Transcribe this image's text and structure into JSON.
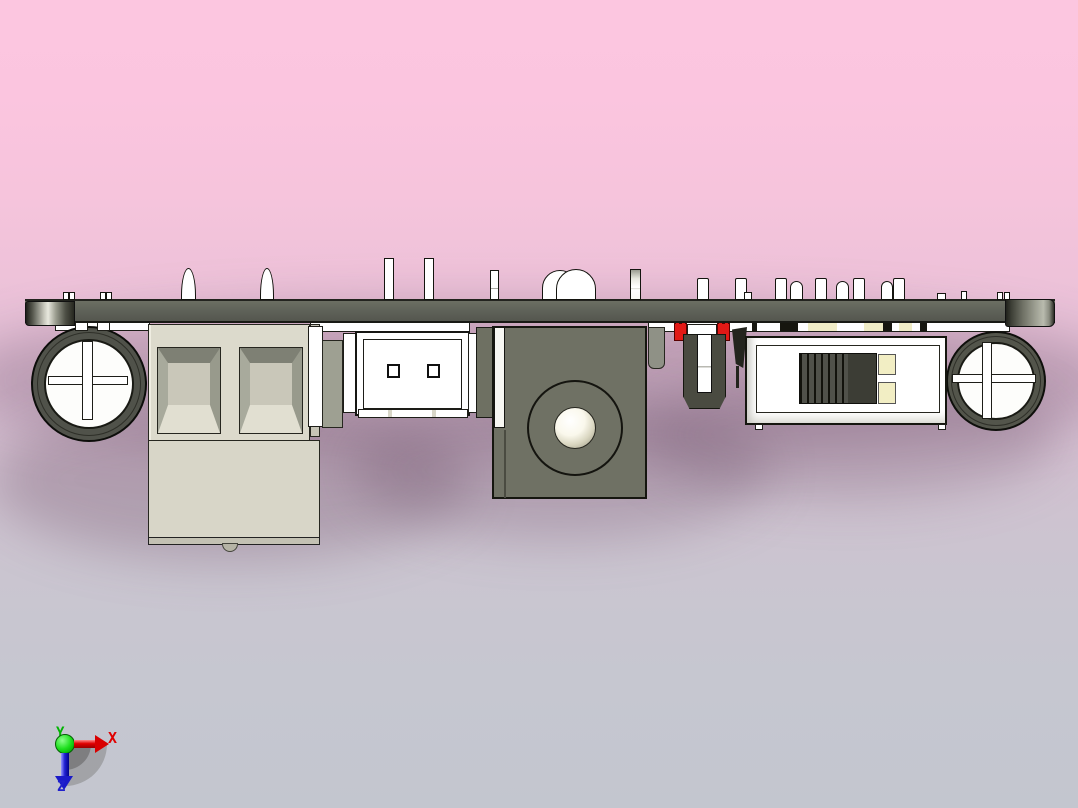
{
  "viewport": {
    "type": "3d-cad-view",
    "axis_triad": {
      "x_label": "X",
      "y_label": "Y",
      "z_label": "Z",
      "x_color": "#e00000",
      "y_color": "#00b400",
      "z_color": "#2020cc",
      "origin_color": "#12c012"
    },
    "background": {
      "top": "#fcc6e0",
      "middle": "#d5bfd2",
      "bottom": "#c3c6cf"
    },
    "board": {
      "color": "#60635a",
      "edge_color": "#1a1b16"
    },
    "component_colors": {
      "capacitor_ring": "#50524a",
      "capacitor_face": "#fdfdfb",
      "terminal_block": "#dcdacc",
      "connector_white": "#ffffff",
      "barrel_jack": "#6f7164",
      "jumper_red": "#e21916",
      "switch_slider": "#3c3d35",
      "switch_pads": "#f2eec4"
    },
    "components": [
      "electrolytic-capacitor-left",
      "screw-terminal-block",
      "jst-connector",
      "dc-barrel-jack",
      "red-jumpers",
      "slide-switch",
      "electrolytic-capacitor-right",
      "pin-headers",
      "led-dome"
    ]
  }
}
